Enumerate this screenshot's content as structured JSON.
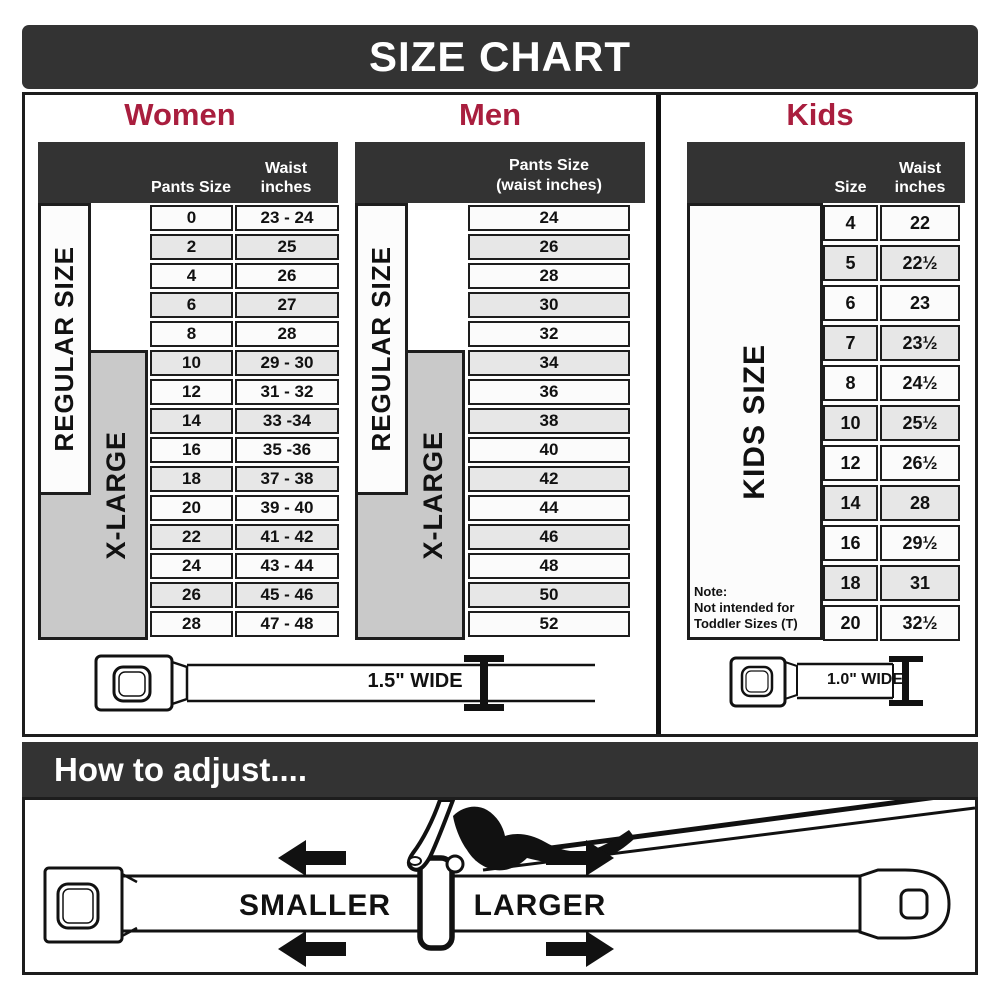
{
  "title": "SIZE CHART",
  "colors": {
    "banner_bg": "#333333",
    "accent": "#a91e3e",
    "row_light": "#fbfbfb",
    "row_shade": "#e7e7e7",
    "xlarge_bg": "#c9c9c9",
    "border": "#1d1d1d"
  },
  "women": {
    "heading": "Women",
    "col1_header": "Pants Size",
    "col2_header": [
      "Waist",
      "inches"
    ],
    "regular_label": "REGULAR SIZE",
    "xlarge_label": "X-LARGE",
    "rows": [
      {
        "size": "0",
        "waist": "23 - 24"
      },
      {
        "size": "2",
        "waist": "25"
      },
      {
        "size": "4",
        "waist": "26"
      },
      {
        "size": "6",
        "waist": "27"
      },
      {
        "size": "8",
        "waist": "28"
      },
      {
        "size": "10",
        "waist": "29 - 30"
      },
      {
        "size": "12",
        "waist": "31 - 32"
      },
      {
        "size": "14",
        "waist": "33 -34"
      },
      {
        "size": "16",
        "waist": "35 -36"
      },
      {
        "size": "18",
        "waist": "37 - 38"
      },
      {
        "size": "20",
        "waist": "39 - 40"
      },
      {
        "size": "22",
        "waist": "41 - 42"
      },
      {
        "size": "24",
        "waist": "43 - 44"
      },
      {
        "size": "26",
        "waist": "45 - 46"
      },
      {
        "size": "28",
        "waist": "47 - 48"
      }
    ]
  },
  "men": {
    "heading": "Men",
    "col_header": [
      "Pants Size",
      "(waist inches)"
    ],
    "regular_label": "REGULAR SIZE",
    "xlarge_label": "X-LARGE",
    "rows": [
      "24",
      "26",
      "28",
      "30",
      "32",
      "34",
      "36",
      "38",
      "40",
      "42",
      "44",
      "46",
      "48",
      "50",
      "52"
    ]
  },
  "kids": {
    "heading": "Kids",
    "col1_header": "Size",
    "col2_header": [
      "Waist",
      "inches"
    ],
    "side_label": "KIDS SIZE",
    "note": [
      "Note:",
      "Not intended for",
      "Toddler Sizes (T)"
    ],
    "rows": [
      {
        "size": "4",
        "waist": "22"
      },
      {
        "size": "5",
        "waist": "22½"
      },
      {
        "size": "6",
        "waist": "23"
      },
      {
        "size": "7",
        "waist": "23½"
      },
      {
        "size": "8",
        "waist": "24½"
      },
      {
        "size": "10",
        "waist": "25½"
      },
      {
        "size": "12",
        "waist": "26½"
      },
      {
        "size": "14",
        "waist": "28"
      },
      {
        "size": "16",
        "waist": "29½"
      },
      {
        "size": "18",
        "waist": "31"
      },
      {
        "size": "20",
        "waist": "32½"
      }
    ]
  },
  "belts": {
    "adult_width_label": "1.5\" WIDE",
    "kids_width_label": "1.0\" WIDE"
  },
  "how_to": {
    "heading": "How to adjust....",
    "smaller_label": "SMALLER",
    "larger_label": "LARGER"
  }
}
